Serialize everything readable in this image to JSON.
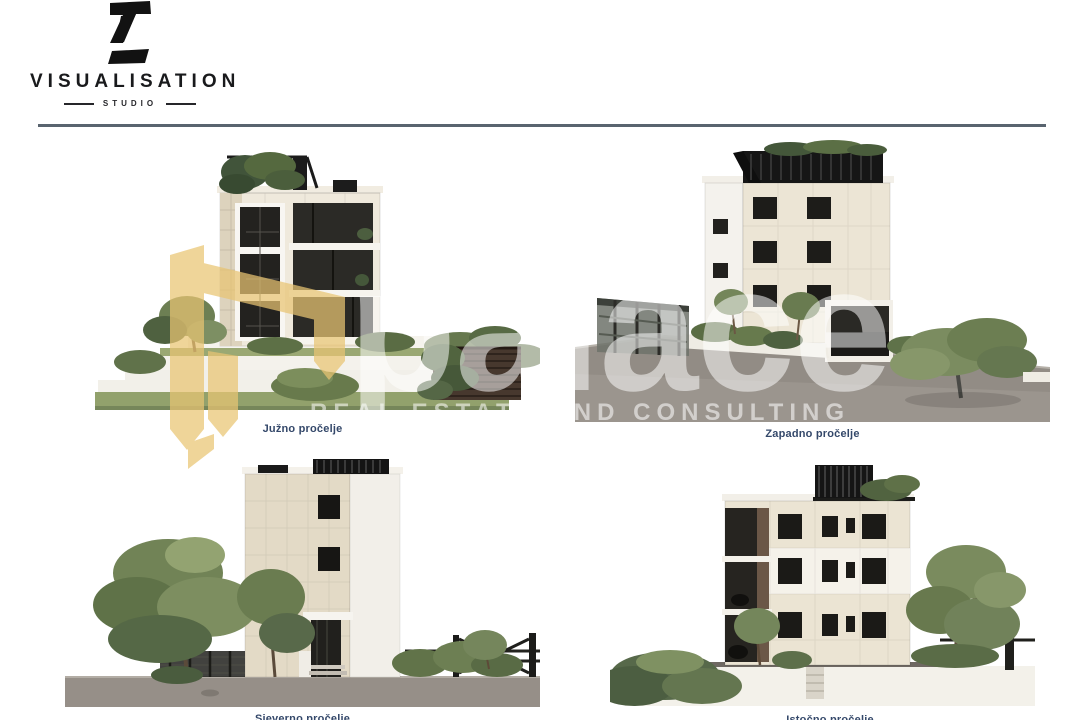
{
  "logo": {
    "mark": "Z",
    "title": "VISUALISATION",
    "subtitle": "STUDIO"
  },
  "colors": {
    "divider": "#59646f",
    "caption_text": "#34486a",
    "watermark_gold": "#e9c573",
    "facade_cream": "#efe9dc",
    "facade_stone": "#ddd3bd",
    "window_dark": "#1f1e1c",
    "pergola_black": "#161616",
    "asphalt": "#948e87"
  },
  "watermark": {
    "brand": "palace",
    "tagline": "REAL ESTATE AND CONSULTING",
    "house_icon": "house-ribbon-icon"
  },
  "figures": [
    {
      "id": "south",
      "caption": "Južno pročelje"
    },
    {
      "id": "west",
      "caption": "Zapadno pročelje"
    },
    {
      "id": "north",
      "caption": "Sjeverno pročelje"
    },
    {
      "id": "east",
      "caption": "Istočno pročelje"
    }
  ]
}
